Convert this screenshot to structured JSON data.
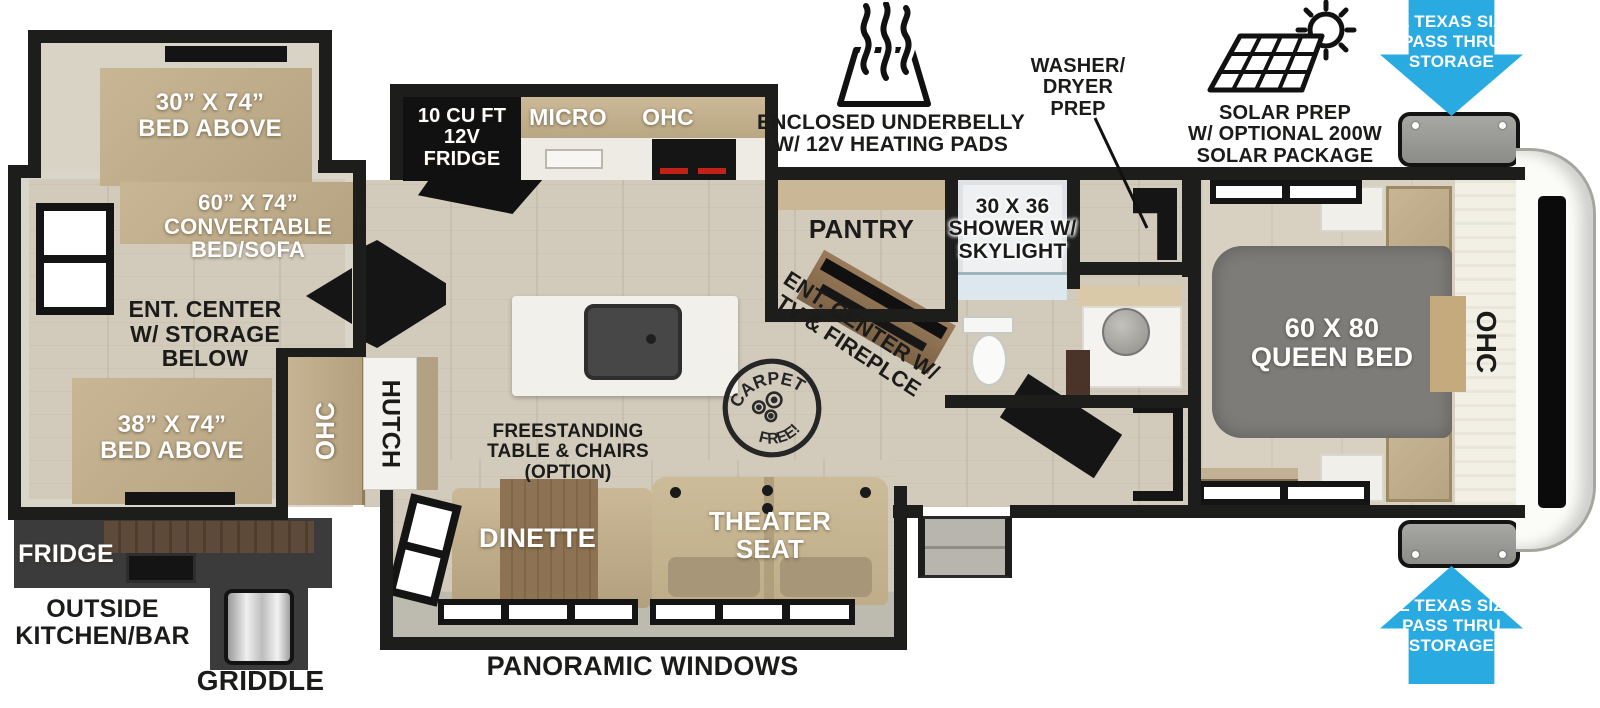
{
  "colors": {
    "wall": "#1d1d1b",
    "floor_wood": "#d2cabb",
    "cabinet_tan": "#c2b08f",
    "bed_gray": "#7d7c79",
    "outside_kitchen_dark": "#3b3b3b",
    "pass_thru_blue": "#29abe2",
    "counter_white": "#f2f0ea"
  },
  "bunk_room": {
    "bed_above_30": "30” X 74”\nBED ABOVE",
    "convertible_bed": "60” X 74”\nCONVERTABLE\nBED/SOFA",
    "ent_center": "ENT. CENTER\nW/ STORAGE\nBELOW",
    "bed_above_38": "38” X 74”\nBED ABOVE",
    "ohc": "OHC",
    "hutch": "HUTCH"
  },
  "outside_kitchen": {
    "fridge": "FRIDGE",
    "label": "OUTSIDE\nKITCHEN/BAR",
    "griddle": "GRIDDLE"
  },
  "kitchen": {
    "fridge_12v": "10 CU FT\n12V\nFRIDGE",
    "micro": "MICRO",
    "ohc": "OHC",
    "pantry": "PANTRY"
  },
  "bathroom": {
    "shower": "30 X 36\nSHOWER W/\nSKYLIGHT"
  },
  "living": {
    "ent_center_tv": "ENT. CENTER W/\nTV & FIREPLCE",
    "freestanding": "FREESTANDING\nTABLE & CHAIRS\n(OPTION)",
    "dinette": "DINETTE",
    "theater_seat": "THEATER\nSEAT"
  },
  "bedroom": {
    "queen_bed": "60 X 80\nQUEEN BED",
    "ohc": "OHC"
  },
  "annotations": {
    "enclosed_underbelly": "ENCLOSED UNDERBELLY\nW/ 12V HEATING PADS",
    "washer_dryer_prep": "WASHER/\nDRYER\nPREP",
    "solar_prep": "SOLAR PREP\nW/ OPTIONAL 200W\nSOLAR PACKAGE",
    "pass_thru_top": "XL TEXAS SIZE\nPASS THRU\nSTORAGE",
    "pass_thru_bottom": "XL TEXAS SIZE\nPASS THRU\nSTORAGE",
    "panoramic_windows": "PANORAMIC WINDOWS",
    "carpet_free_top": "CARPET",
    "carpet_free_bottom": "FREE!"
  }
}
